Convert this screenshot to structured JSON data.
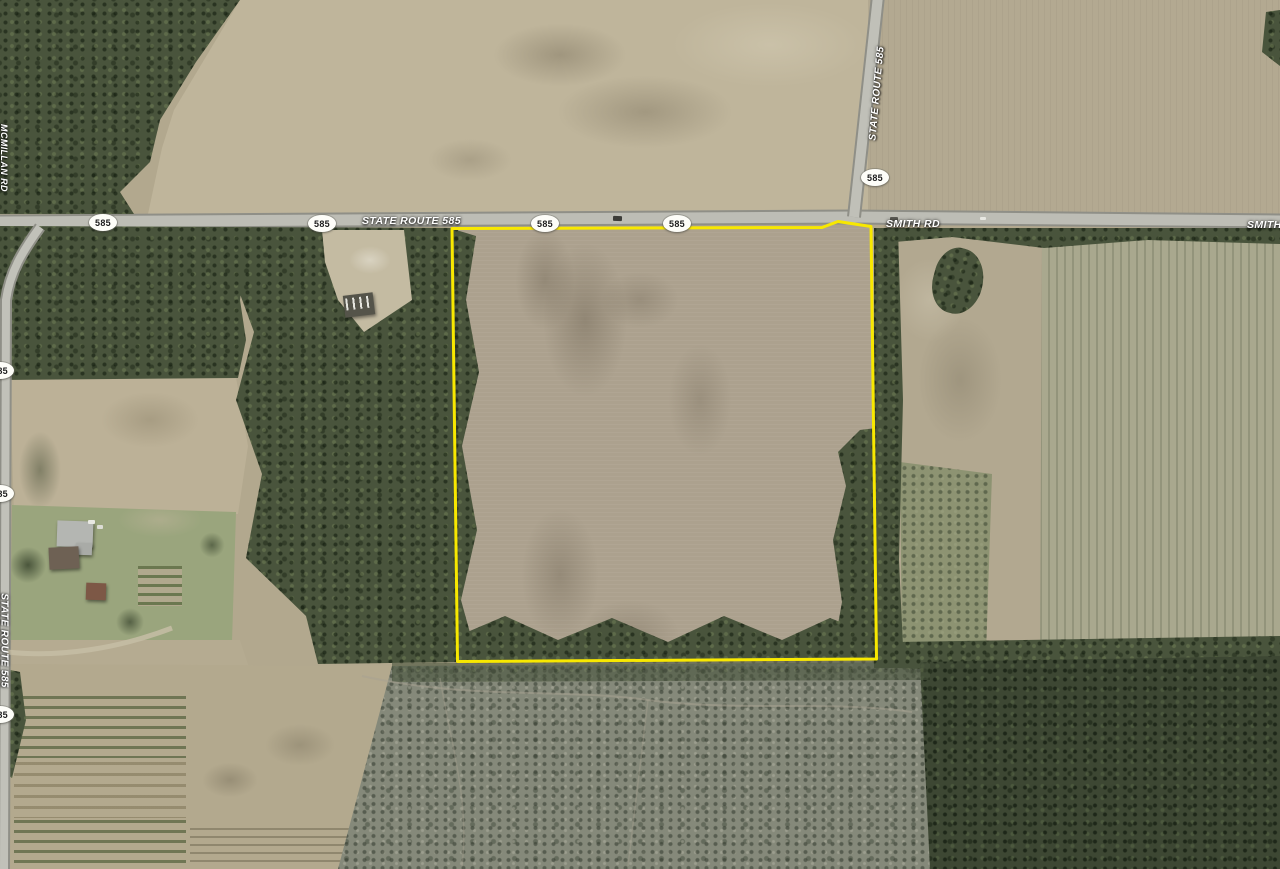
{
  "map": {
    "view": "satellite-imagery",
    "labels": [
      {
        "id": "mcmillan-rd",
        "text": "MCMILLAN RD"
      },
      {
        "id": "state-route-585-west",
        "text": "STATE ROUTE 585"
      },
      {
        "id": "state-route-585-north",
        "text": "STATE ROUTE 585"
      },
      {
        "id": "smith-rd",
        "text": "SMITH RD"
      },
      {
        "id": "smith-rd-east",
        "text": "SMITH RD"
      },
      {
        "id": "state-route-585-south",
        "text": "STATE ROUTE 585"
      }
    ],
    "shields": [
      {
        "id": "shield-sr585-w1",
        "label": "585"
      },
      {
        "id": "shield-sr585-w2",
        "label": "585"
      },
      {
        "id": "shield-sr585-w3",
        "label": "585"
      },
      {
        "id": "shield-sr585-w4",
        "label": "585"
      },
      {
        "id": "shield-sr585-north",
        "label": "585"
      },
      {
        "id": "shield-sr585-left1",
        "label": "585"
      },
      {
        "id": "shield-sr585-left2",
        "label": "585"
      },
      {
        "id": "shield-sr585-left3",
        "label": "585"
      }
    ],
    "colors": {
      "parcel_outline": "#f8e800"
    }
  }
}
